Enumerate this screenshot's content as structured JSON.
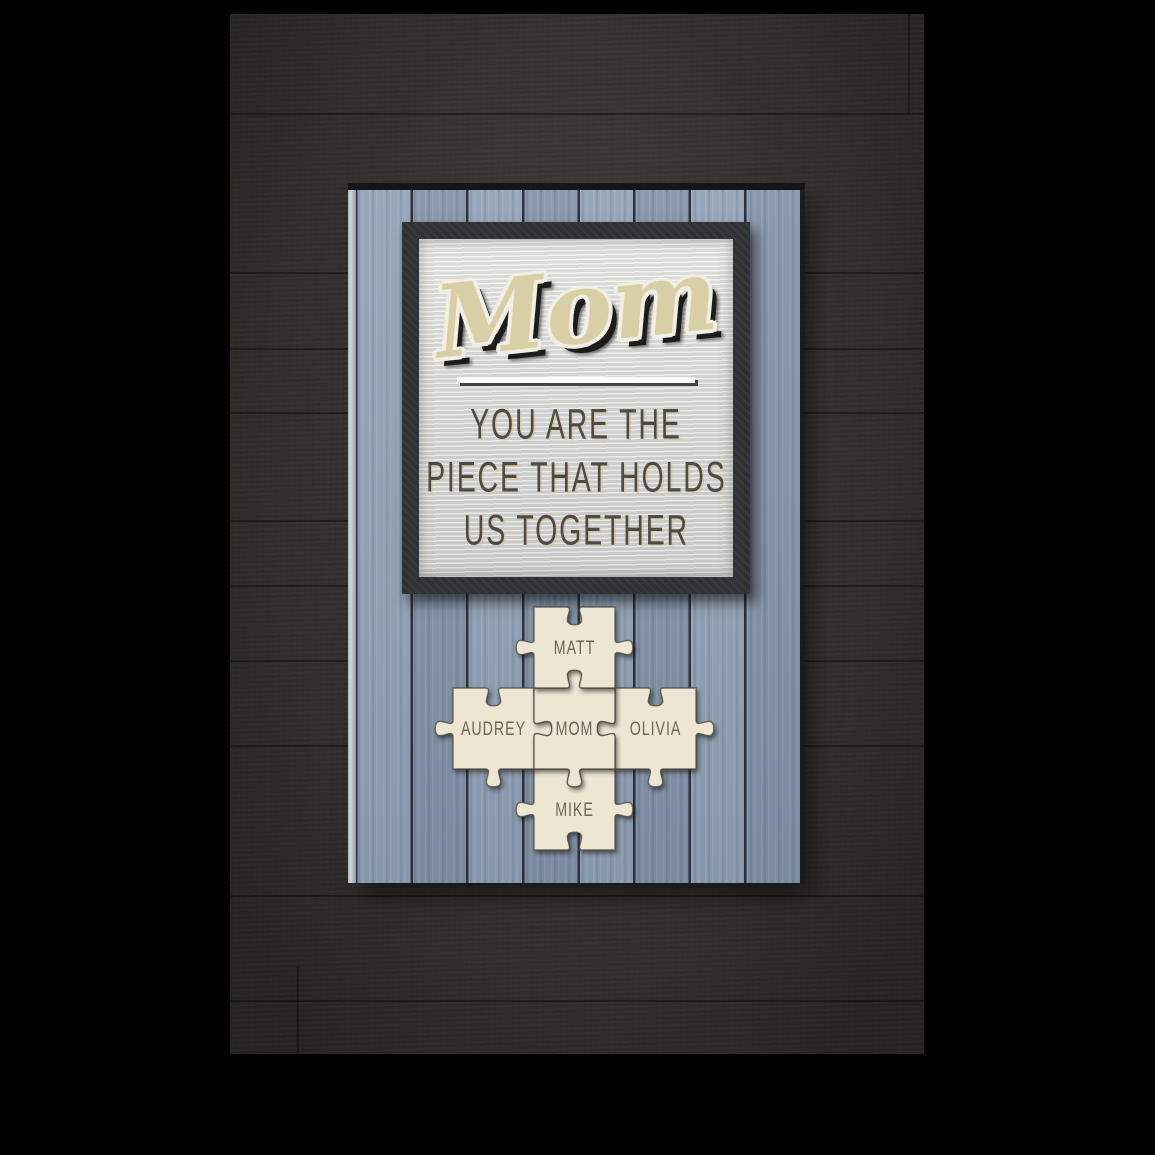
{
  "poster": {
    "sign": {
      "title": "Mom",
      "subtitle_lines": [
        "YOU ARE THE",
        "PIECE THAT HOLDS",
        "US TOGETHER"
      ],
      "puzzle": {
        "center_name": "MOM",
        "pieces": [
          {
            "name": "MIKE",
            "col": 1,
            "row": 2,
            "edges": [
              "blank",
              "tab",
              "blank",
              "tab"
            ]
          },
          {
            "name": "AUDREY",
            "col": 0,
            "row": 1,
            "edges": [
              "blank",
              "tab",
              "tab",
              "tab"
            ]
          },
          {
            "name": "OLIVIA",
            "col": 2,
            "row": 1,
            "edges": [
              "blank",
              "tab",
              "tab",
              "tab"
            ]
          },
          {
            "name": "MOM",
            "col": 1,
            "row": 1,
            "edges": [
              "tab",
              "blank",
              "tab",
              "blank"
            ]
          },
          {
            "name": "MATT",
            "col": 1,
            "row": 0,
            "edges": [
              "blank",
              "tab",
              "blank",
              "tab"
            ]
          }
        ]
      }
    },
    "colors": {
      "background": "#000000",
      "wall_wood": "#403d3a",
      "plank_blue": "#8c9bb0",
      "frame_charcoal": "#2f3234",
      "panel_white": "#dededc",
      "title_tan": "#d9cfa6",
      "subtitle_gray": "#4e4b44",
      "puzzle_cream": "#ece6d3",
      "puzzle_text": "#6b675a"
    }
  }
}
